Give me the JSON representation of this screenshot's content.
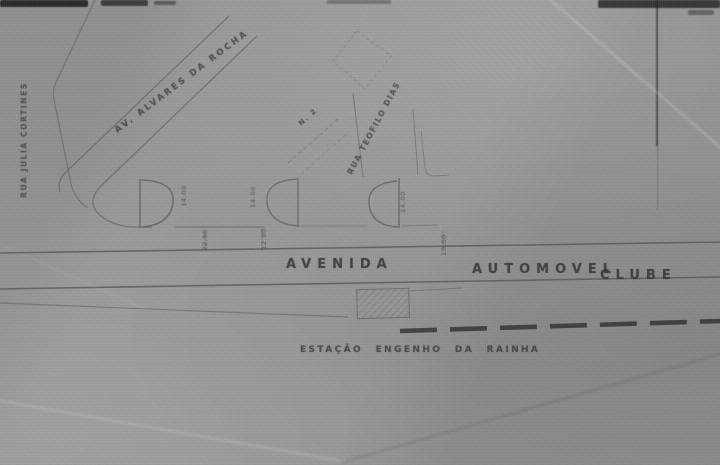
{
  "meta": {
    "description": "Scanned engineering street plan (grey photostat)"
  },
  "colors": {
    "paper": "#989898",
    "ink": "#555555",
    "railway": "#2e2e2e",
    "smudge": "#1a1a1a"
  },
  "streets": {
    "diagonal_avenue": "AV. ALVARES DA ROCHA",
    "left_street": "RUA JULIA CORTINES",
    "middle_street": "RUA TEOFILO DIAS",
    "avenue_word": "AVENIDA",
    "avenue_name_1": "AUTOMOVEL",
    "avenue_name_2": "CLUBE"
  },
  "station": {
    "label": "ESTAÇÃO ENGENHO DA RAINHA"
  },
  "annotations": {
    "parcel": "N. 2",
    "dims": [
      {
        "text": "14.00"
      },
      {
        "text": "14.00"
      },
      {
        "text": "14.00"
      },
      {
        "text": "22.00"
      },
      {
        "text": "12.00"
      },
      {
        "text": "10.00"
      }
    ]
  }
}
